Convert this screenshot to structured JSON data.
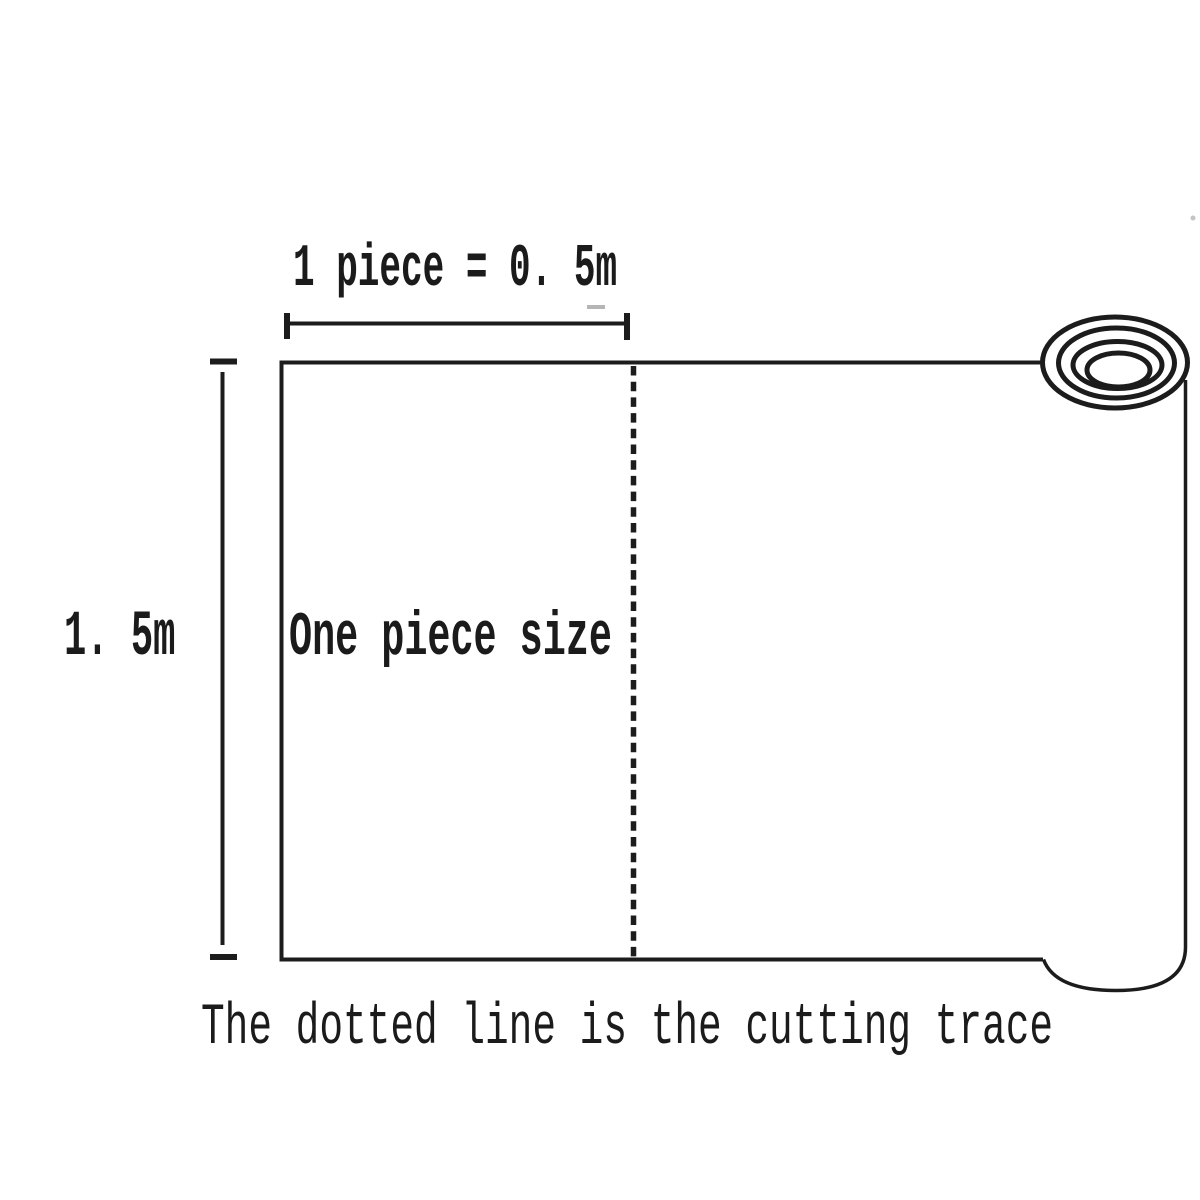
{
  "page": {
    "background": "#ffffff",
    "ink_color": "#1c1c1c"
  },
  "diagram": {
    "top_dimension_label": "1 piece = 0. 5m",
    "height_label": "1. 5m",
    "piece_label": "One piece size",
    "caption": "The dotted line is the cutting trace",
    "icons": {
      "roll": "fabric-roll-icon",
      "cutting_line": "dashed-cutting-line",
      "width_dimension": "width-dimension-line",
      "height_dimension": "height-dimension-line"
    }
  }
}
